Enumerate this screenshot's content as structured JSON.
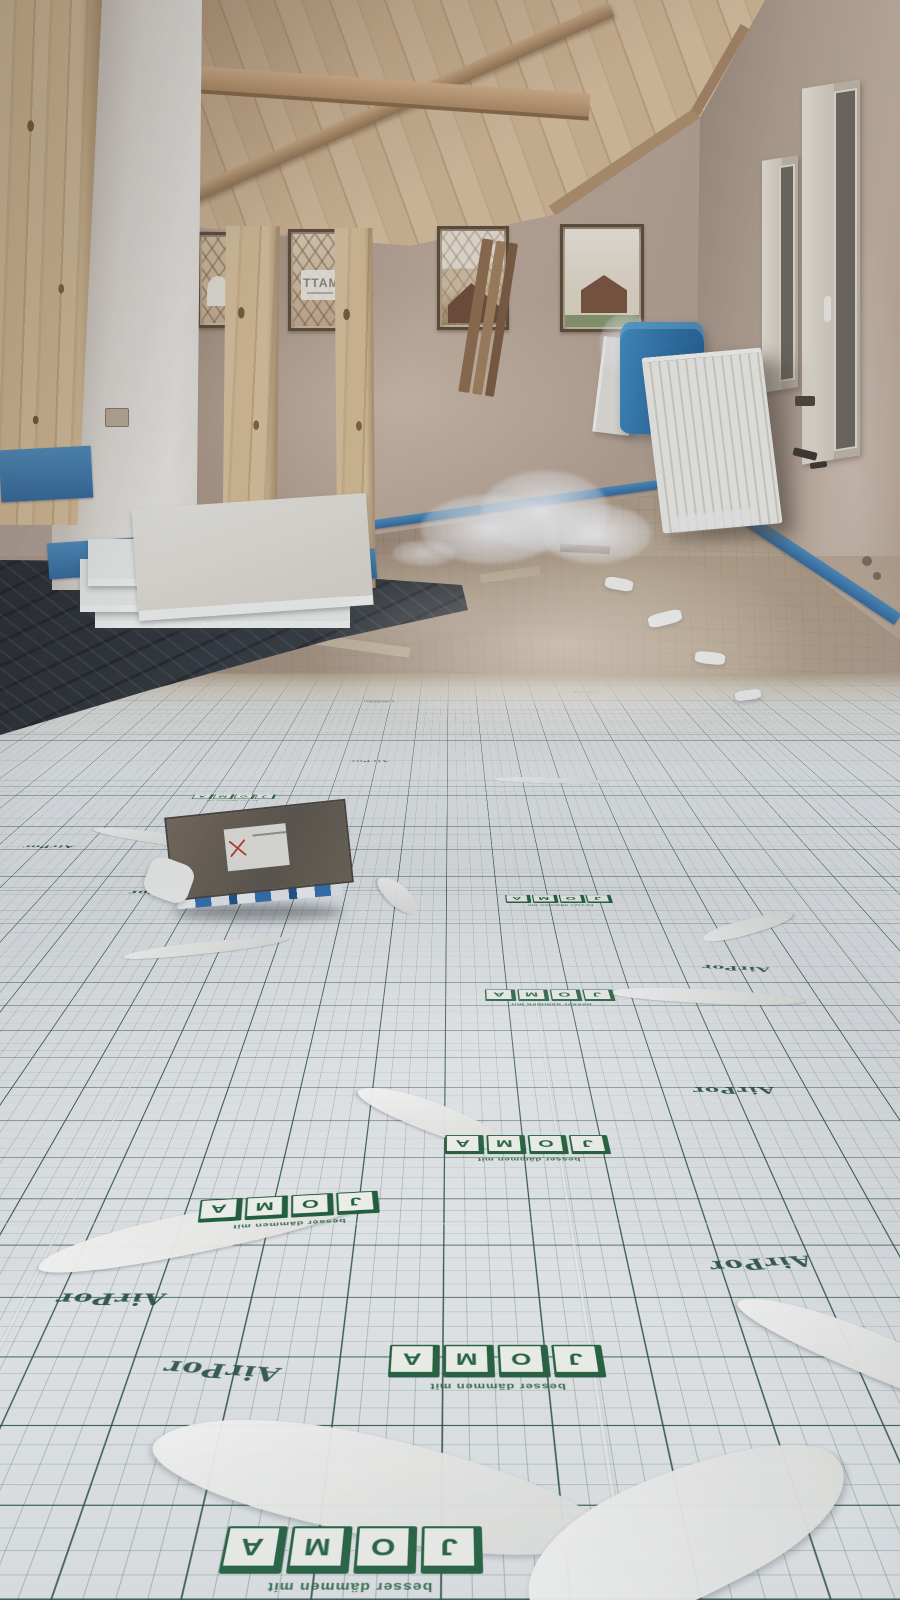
{
  "brand": {
    "joma_letters": [
      "J",
      "O",
      "M",
      "A"
    ],
    "joma_caption": "besser dämmen mit",
    "airpor_label": "AirPor"
  },
  "window_sticker": {
    "text": "MATT"
  },
  "colors": {
    "grid_green": "#2a5243",
    "logo_green": "#1c5c38",
    "tape_blue": "#3f7fb5",
    "bin_blue": "#2f7fb5",
    "membrane_black": "#2a2e33",
    "wood_light": "#d9bd9a",
    "wall_beige": "#bfab9b",
    "panel_white": "#e9ebec"
  }
}
